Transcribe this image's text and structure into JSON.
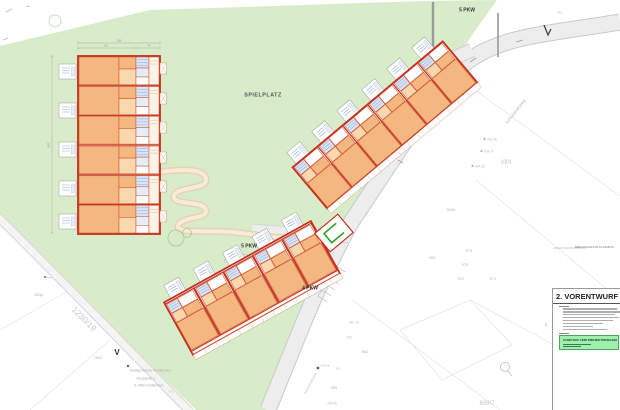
{
  "title_block": {
    "heading": "2. VORENTWURF",
    "company": "AUER BAU UND PROJEKTMANAGEMENT",
    "note": "BEBAUUNGSPLAN FA-KAMPUS"
  },
  "colors": {
    "site_green": "#d9ecca",
    "road_gray": "#ededed",
    "wall_red": "#c4331f",
    "room_orange": "#f4b77f",
    "room_light": "#f9d8ae",
    "bath_blue": "#d8e5f6",
    "footpath_tan": "#e7d2b4",
    "highlight_green": "#9ff0ae"
  },
  "labels": [
    {
      "text": "SPIELPLATZ",
      "x": 263,
      "y": 96,
      "s": 5.4,
      "c": "#555555",
      "b": true,
      "ls": 0.5,
      "name": "label-spielplatz"
    },
    {
      "text": "5 PKW",
      "x": 467,
      "y": 11,
      "s": 5,
      "c": "#333333",
      "b": true,
      "name": "label-5pkw-top"
    },
    {
      "text": "5 PKW",
      "x": 249,
      "y": 247,
      "s": 5,
      "c": "#333333",
      "b": true,
      "name": "label-5pkw-mid"
    },
    {
      "text": "4 PKW",
      "x": 310,
      "y": 289,
      "s": 5,
      "c": "#333333",
      "b": true,
      "name": "label-4pkw"
    },
    {
      "text": "Schulstraßweg",
      "x": 516,
      "y": 112,
      "s": 4.5,
      "c": "#b8b8b8",
      "r": -52,
      "name": "label-street-name"
    },
    {
      "text": "Schulstraßweg",
      "x": 311,
      "y": 384,
      "s": 3.6,
      "c": "#c4c4c4",
      "r": -63,
      "name": "label-street-name-2"
    },
    {
      "text": "1230/19",
      "x": 84,
      "y": 319,
      "s": 8.5,
      "c": "#c9c9c9",
      "r": 45,
      "name": "label-parcel-1230-19"
    },
    {
      "text": "853p",
      "x": 39,
      "y": 295,
      "s": 4,
      "c": "#b5b5b5"
    },
    {
      "text": "1002",
      "x": 98,
      "y": 358,
      "s": 4,
      "c": "#b5b5b5"
    },
    {
      "text": "V",
      "x": 117,
      "y": 353,
      "s": 8,
      "c": "#333333",
      "b": true,
      "name": "label-v-mark"
    },
    {
      "text": "Stadtgemeinde Feldkirchen",
      "x": 150,
      "y": 371,
      "s": 3.4,
      "c": "#ababab"
    },
    {
      "text": "Hauptplatz 1",
      "x": 146,
      "y": 378.5,
      "s": 3.4,
      "c": "#ababab"
    },
    {
      "text": "A-9560 Feldkirchen",
      "x": 149,
      "y": 386,
      "s": 3.4,
      "c": "#ababab"
    },
    {
      "text": "470",
      "x": 171,
      "y": 392,
      "s": 3,
      "c": "#b5b5b5"
    },
    {
      "text": "1001",
      "x": 506,
      "y": 163,
      "s": 5,
      "c": "#bdbdbd"
    },
    {
      "text": "453.38",
      "x": 492,
      "y": 140,
      "s": 3.2,
      "c": "#bdbdbd"
    },
    {
      "text": "454.37",
      "x": 489,
      "y": 152,
      "s": 3.2,
      "c": "#bdbdbd"
    },
    {
      "text": "454.33",
      "x": 480,
      "y": 167,
      "s": 3.2,
      "c": "#bdbdbd"
    },
    {
      "text": "964b",
      "x": 451,
      "y": 210,
      "s": 4,
      "c": "#b5b5b5"
    },
    {
      "text": "963",
      "x": 432,
      "y": 258,
      "s": 4,
      "c": "#b5b5b5"
    },
    {
      "text": "973",
      "x": 469,
      "y": 251,
      "s": 4,
      "c": "#b5b5b5"
    },
    {
      "text": "970",
      "x": 465,
      "y": 265,
      "s": 4,
      "c": "#b5b5b5"
    },
    {
      "text": "972",
      "x": 461,
      "y": 279,
      "s": 4,
      "c": "#b5b5b5"
    },
    {
      "text": "971",
      "x": 493,
      "y": 279,
      "s": 4,
      "c": "#b5b5b5"
    },
    {
      "text": "467.16",
      "x": 354,
      "y": 323,
      "s": 3.2,
      "c": "#bdbdbd"
    },
    {
      "text": "236",
      "x": 349,
      "y": 338,
      "s": 3.2,
      "c": "#bdbdbd"
    },
    {
      "text": "962",
      "x": 365,
      "y": 352,
      "s": 4,
      "c": "#b5b5b5"
    },
    {
      "text": "466.08",
      "x": 325,
      "y": 366,
      "s": 2.8,
      "c": "#bdbdbd"
    },
    {
      "text": "967",
      "x": 338,
      "y": 369,
      "s": 2.8,
      "c": "#bdbdbd"
    },
    {
      "text": "959",
      "x": 334,
      "y": 388,
      "s": 4,
      "c": "#b5b5b5"
    },
    {
      "text": "458.68",
      "x": 332,
      "y": 404,
      "s": 3.2,
      "c": "#bdbdbd"
    },
    {
      "text": "609/7",
      "x": 487,
      "y": 404,
      "s": 6,
      "c": "#c2c2c2",
      "name": "label-parcel-609-7"
    },
    {
      "text": "6",
      "x": 546,
      "y": 326,
      "s": 5,
      "c": "#c2c2c2"
    },
    {
      "text": "453.",
      "x": 560,
      "y": 13,
      "s": 3,
      "c": "#bdbdbd"
    },
    {
      "text": "196",
      "x": 119,
      "y": 40.5,
      "s": 2.8,
      "c": "#999999"
    },
    {
      "text": "150",
      "x": 106,
      "y": 46,
      "s": 2.8,
      "c": "#999999"
    },
    {
      "text": "46",
      "x": 149,
      "y": 46,
      "s": 2.8,
      "c": "#999999"
    },
    {
      "text": "887",
      "x": 49,
      "y": 145,
      "s": 2.8,
      "c": "#999999",
      "r": -90
    }
  ]
}
